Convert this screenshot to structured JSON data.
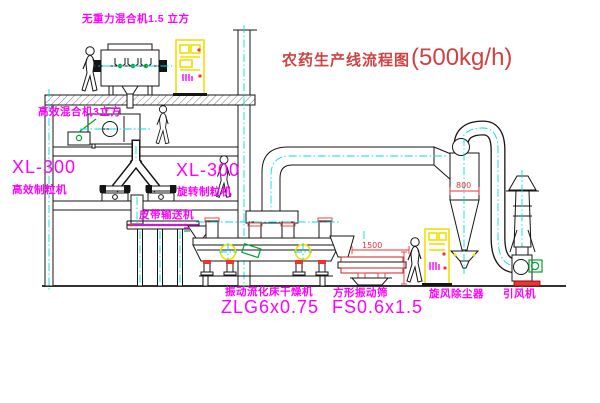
{
  "title": {
    "text": "农药生产线流程图",
    "capacity": "(500kg/h)"
  },
  "labels": {
    "top_mixer": "无重力混合机1.5 立方",
    "floor2_mixer": "高效混合机3立方",
    "granulator_left": {
      "model": "XL-300",
      "name": "高效制粒机"
    },
    "granulator_mid": {
      "model": "XL-300",
      "name": "旋转制粒机"
    },
    "belt_conveyor": "皮带输送机",
    "dryer": {
      "name": "振动流化床干燥机",
      "model": "ZLG6x0.75"
    },
    "sieve": {
      "name": "方形振动筛",
      "model": "FS0.6x1.5"
    },
    "cyclone": "旋风除尘器",
    "fan": "引风机"
  },
  "dimensions": {
    "cyclone_width": "800",
    "sieve_width": "1500"
  },
  "colors": {
    "label_magenta": "#ff00ff",
    "title_red": "#cf4242",
    "dimension_red": "#ee3333",
    "cabinet_yellow": "#f0e000",
    "centerline_cyan": "#00dede",
    "motor_green": "#00a32e"
  }
}
